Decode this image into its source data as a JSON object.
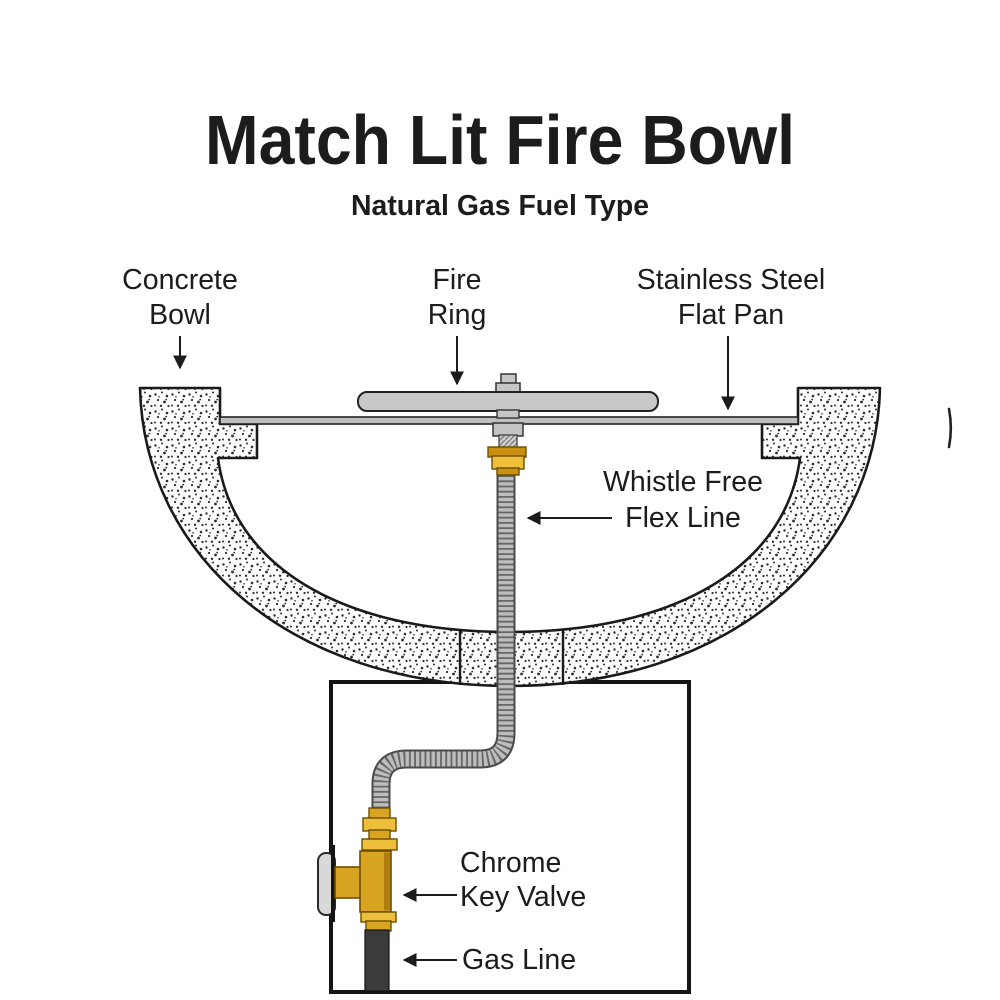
{
  "title": "Match Lit Fire Bowl",
  "subtitle": "Natural Gas Fuel Type",
  "labels": {
    "concrete_bowl": {
      "line1": "Concrete",
      "line2": "Bowl"
    },
    "fire_ring": {
      "line1": "Fire",
      "line2": "Ring"
    },
    "flat_pan": {
      "line1": "Stainless Steel",
      "line2": "Flat Pan"
    },
    "flex_line": {
      "line1": "Whistle Free",
      "line2": "Flex Line"
    },
    "key_valve": {
      "line1": "Chrome",
      "line2": "Key Valve"
    },
    "gas_line": {
      "line1": "Gas Line"
    }
  },
  "colors": {
    "ink": "#1c1c1c",
    "brass": "#d9a421",
    "brass_light": "#edbf3a",
    "brass_dark": "#8a6508",
    "steel_gray": "#c9c9c9",
    "flex_gray": "#bdbdbd",
    "chrome": "#d8d8d8",
    "gas_dark": "#3b3b3b"
  }
}
